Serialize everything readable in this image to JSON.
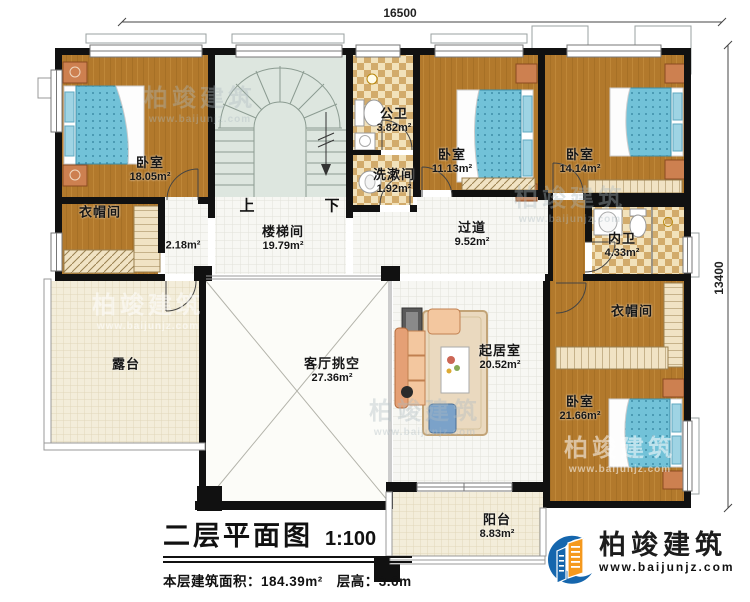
{
  "title_block": {
    "title": "二层平面图",
    "scale": "1:100"
  },
  "stats": {
    "area_label": "本层建筑面积：",
    "area_value": "184.39m²",
    "height_label": "层高：",
    "height_value": "3.6m"
  },
  "dimensions": {
    "top_width": "16500",
    "right_height": "13400"
  },
  "stairs": {
    "up_label": "上",
    "down_label": "下"
  },
  "rooms": {
    "bedroom_tl": {
      "name": "卧室",
      "area": "18.05m²"
    },
    "closet_tl": {
      "name": "衣帽间",
      "area": ""
    },
    "corridor_small": {
      "name": "",
      "area": "2.18m²"
    },
    "stair_hall": {
      "name": "楼梯间",
      "area": "19.79m²"
    },
    "public_bath": {
      "name": "公卫",
      "area": "3.82m²"
    },
    "wash_room": {
      "name": "洗漱间",
      "area": "1.92m²"
    },
    "bedroom_tm": {
      "name": "卧室",
      "area": "11.13m²"
    },
    "bedroom_tr": {
      "name": "卧室",
      "area": "14.14m²"
    },
    "ensuite_bath": {
      "name": "内卫",
      "area": "4.33m²"
    },
    "hallway": {
      "name": "过道",
      "area": "9.52m²"
    },
    "terrace": {
      "name": "露台",
      "area": ""
    },
    "living_void": {
      "name": "客厅挑空",
      "area": "27.36m²"
    },
    "sitting_room": {
      "name": "起居室",
      "area": "20.52m²"
    },
    "closet_br": {
      "name": "衣帽间",
      "area": ""
    },
    "bedroom_br": {
      "name": "卧室",
      "area": "21.66m²"
    },
    "balcony": {
      "name": "阳台",
      "area": "8.83m²"
    }
  },
  "brand": {
    "name": "柏竣建筑",
    "website": "www.baijunjz.com",
    "icon": "building-logo-icon",
    "blue": "#1566ad",
    "orange": "#f5991d"
  },
  "watermark": {
    "name": "柏竣建筑",
    "website": "www.baijunjz.com"
  },
  "colors": {
    "wall": "#111111",
    "wood_floor": "#b2792c",
    "bath_tile_dark": "#d2ab6b",
    "bath_tile_light": "#f2e2bb",
    "stair_floor": "#dde6df",
    "corridor_tile": "#f7f7f3",
    "terrace_tile": "#f3edda",
    "mattress_blue": "#72c2d8"
  }
}
